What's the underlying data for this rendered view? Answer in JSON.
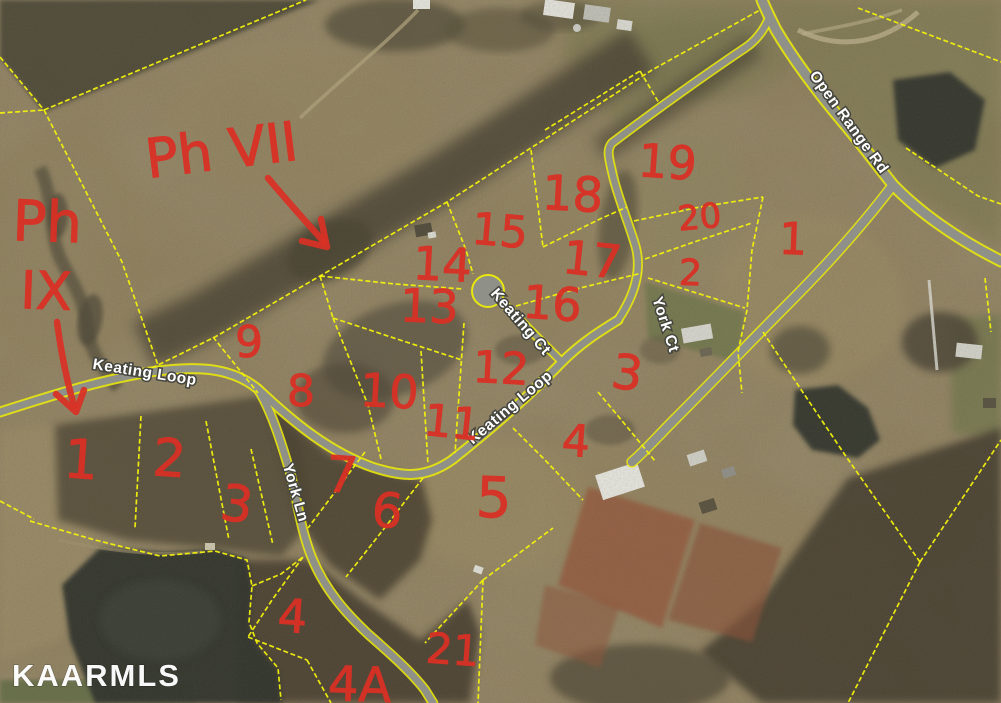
{
  "watermark": "KAARMLS",
  "phase_labels": {
    "phase_vii": "Ph VII",
    "phase_ix_line1": "Ph",
    "phase_ix_line2": "IX"
  },
  "roads": {
    "open_range_rd": "Open Range Rd",
    "keating_loop": "Keating Loop",
    "keating_ct": "Keating Ct",
    "york_ct": "York Ct",
    "york_ln": "York Ln"
  },
  "lots": [
    {
      "label": "19"
    },
    {
      "label": "18"
    },
    {
      "label": "15"
    },
    {
      "label": "14"
    },
    {
      "label": "17"
    },
    {
      "label": "13"
    },
    {
      "label": "16"
    },
    {
      "label": "20"
    },
    {
      "label": "2"
    },
    {
      "label": "1"
    },
    {
      "label": "9"
    },
    {
      "label": "8"
    },
    {
      "label": "10"
    },
    {
      "label": "12"
    },
    {
      "label": "11"
    },
    {
      "label": "3"
    },
    {
      "label": "4"
    },
    {
      "label": "1"
    },
    {
      "label": "2"
    },
    {
      "label": "3"
    },
    {
      "label": "7"
    },
    {
      "label": "6"
    },
    {
      "label": "5"
    },
    {
      "label": "4"
    },
    {
      "label": "21"
    },
    {
      "label": "4A"
    }
  ],
  "colors": {
    "parcel_line": "#f2f10c",
    "road_casing": "#e8e70e",
    "road_fill": "#8f9087",
    "annotation": "#d93025",
    "water": "#2d3229",
    "label_text": "#ffffff"
  }
}
